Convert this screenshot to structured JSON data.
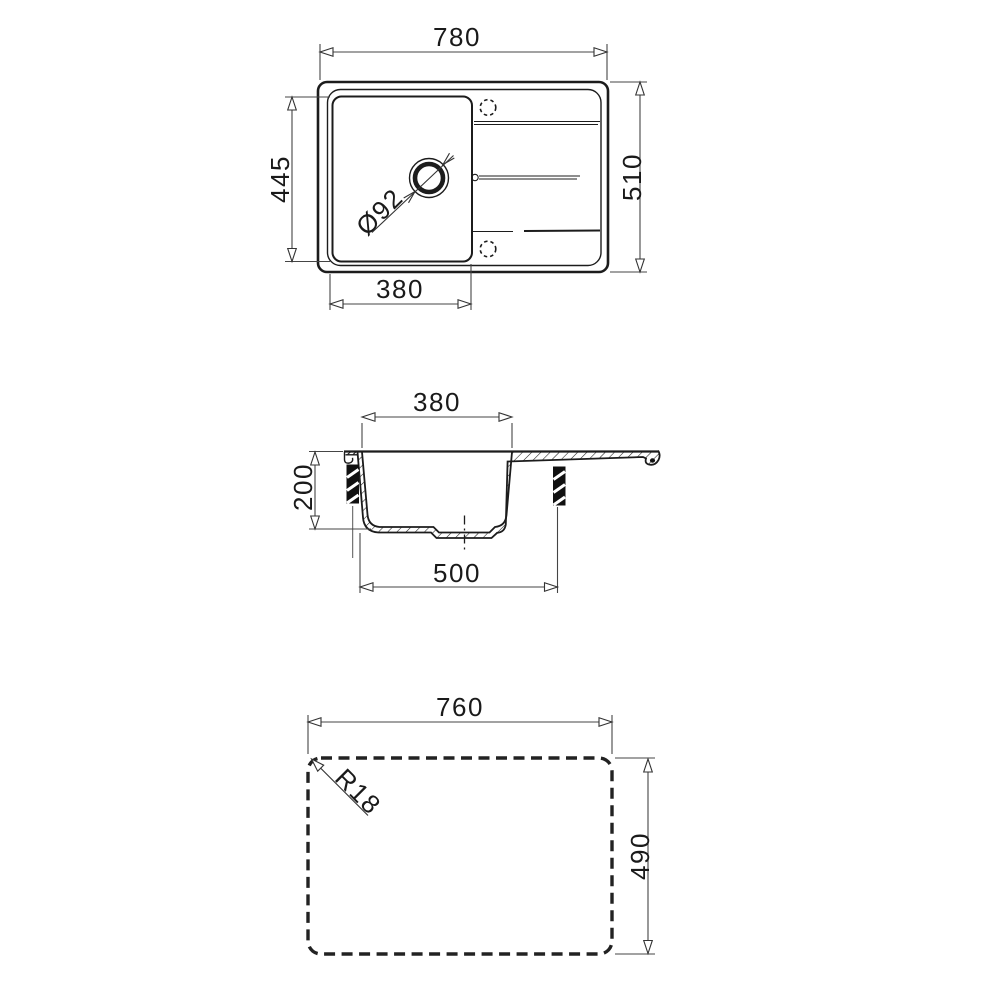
{
  "document": {
    "type": "technical-drawing",
    "subject": "kitchen sink dimension drawing with top view, cross-section and worktop cutout"
  },
  "labels": {
    "top_view": {
      "overall_width": "780",
      "overall_depth": "510",
      "bowl_width": "380",
      "bowl_depth": "445",
      "drain_diameter": "Ø92"
    },
    "section_view": {
      "bowl_top_width": "380",
      "bowl_height": "200",
      "bowl_base_width": "500"
    },
    "cutout_view": {
      "cutout_width": "760",
      "cutout_depth": "490",
      "corner_radius": "R18"
    }
  },
  "colors": {
    "background": "#ffffff",
    "drawing_line": "#1c1c1c",
    "dimension_line": "#454545",
    "text": "#1a1a1a"
  }
}
